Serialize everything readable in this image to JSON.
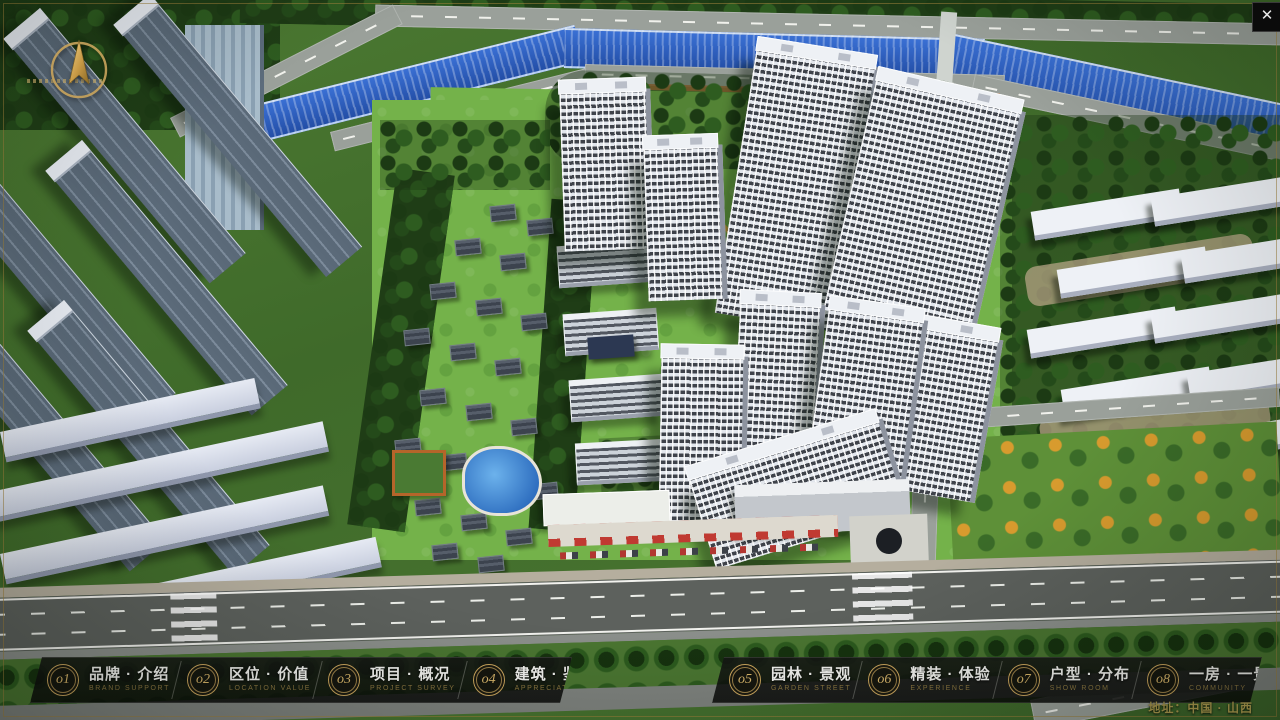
{
  "window": {
    "close_icon": "✕"
  },
  "nav": {
    "items": [
      {
        "num": "o1",
        "zh": "品牌 · 介绍",
        "en": "BRAND SUPPORT"
      },
      {
        "num": "o2",
        "zh": "区位 · 价值",
        "en": "LOCATION VALUE"
      },
      {
        "num": "o3",
        "zh": "项目 · 概况",
        "en": "PROJECT SURVEY"
      },
      {
        "num": "o4",
        "zh": "建筑 · 鉴赏",
        "en": "APPRECIATION"
      },
      {
        "num": "o5",
        "zh": "园林 · 景观",
        "en": "GARDEN STREET"
      },
      {
        "num": "o6",
        "zh": "精装 · 体验",
        "en": "EXPERIENCE"
      },
      {
        "num": "o7",
        "zh": "户型 · 分布",
        "en": "SHOW ROOM"
      },
      {
        "num": "o8",
        "zh": "一房 · 一景",
        "en": "COMMUNITY"
      }
    ]
  },
  "logo": {
    "title": "花語堂"
  },
  "footer": {
    "address": "地址：中国 · 山西"
  },
  "colors": {
    "gold": "#c9a55e",
    "nav_bg": "#0d0f0d",
    "river_blue": "#2d5fc0"
  }
}
